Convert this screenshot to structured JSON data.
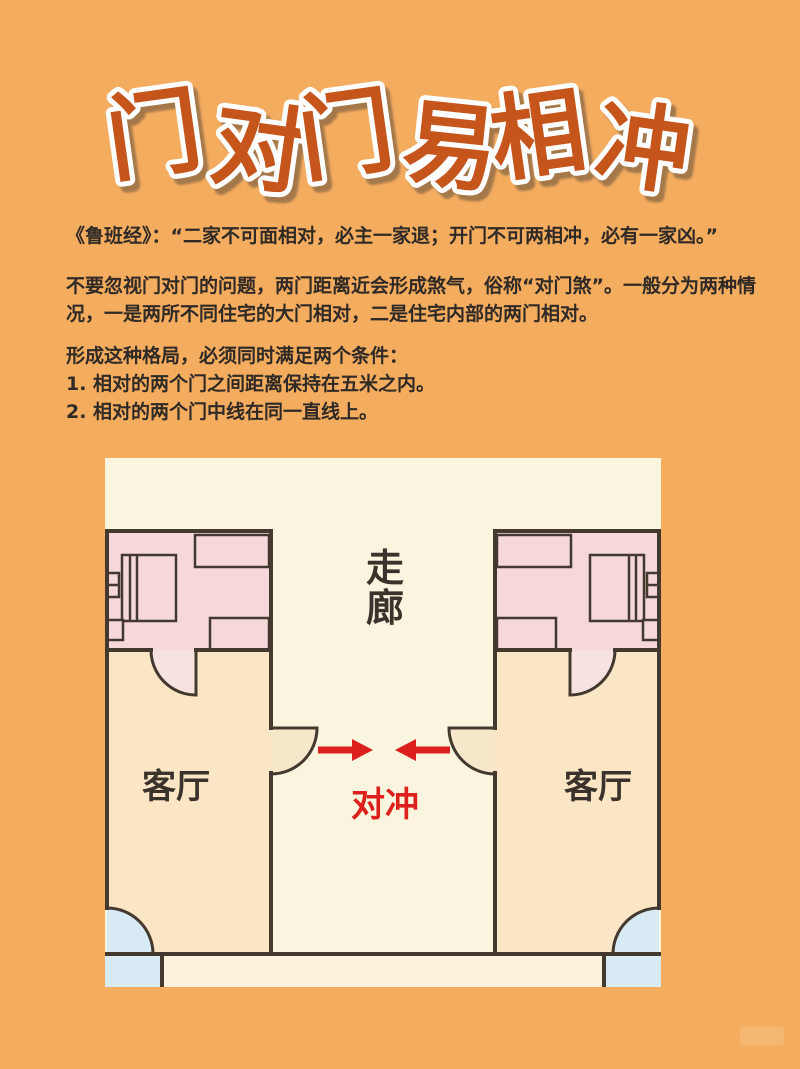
{
  "title": {
    "text": "门对门易相冲"
  },
  "intro": {
    "quote": "《鲁班经》：“二家不可面相对，必主一家退；开门不可两相冲，必有一家凶。”",
    "paragraph": "不要忽视门对门的问题，两门距离近会形成煞气，俗称“对门煞”。一般分为两种情况，一是两所不同住宅的大门相对，二是住宅内部的两门相对。",
    "conditions_title": "形成这种格局，必须同时满足两个条件：",
    "conditions": [
      "1. 相对的两个门之间距离保持在五米之内。",
      "2. 相对的两个门中线在同一直线上。"
    ]
  },
  "diagram": {
    "corridor_label": "走廊",
    "clash_label": "对冲",
    "left_apartment": {
      "room_label": "客厅"
    },
    "right_apartment": {
      "room_label": "客厅"
    }
  },
  "colors": {
    "bg": "#F4AC5F",
    "title_fill": "#C6541B",
    "title_outline": "#FFFFFF",
    "text_dark": "#2F2A26",
    "label_dark": "#3B332B",
    "red": "#DC201D",
    "panel_cream": "#FBF4DE",
    "strip_cream": "#FCF2DB",
    "room_peach": "#FAE6C5",
    "room_pink": "#F6D8DB",
    "door_cream": "#F7E8CB",
    "door_pink": "#F8E2E0",
    "window_blue": "#D8EAF4",
    "wall_dark": "#44392F"
  }
}
